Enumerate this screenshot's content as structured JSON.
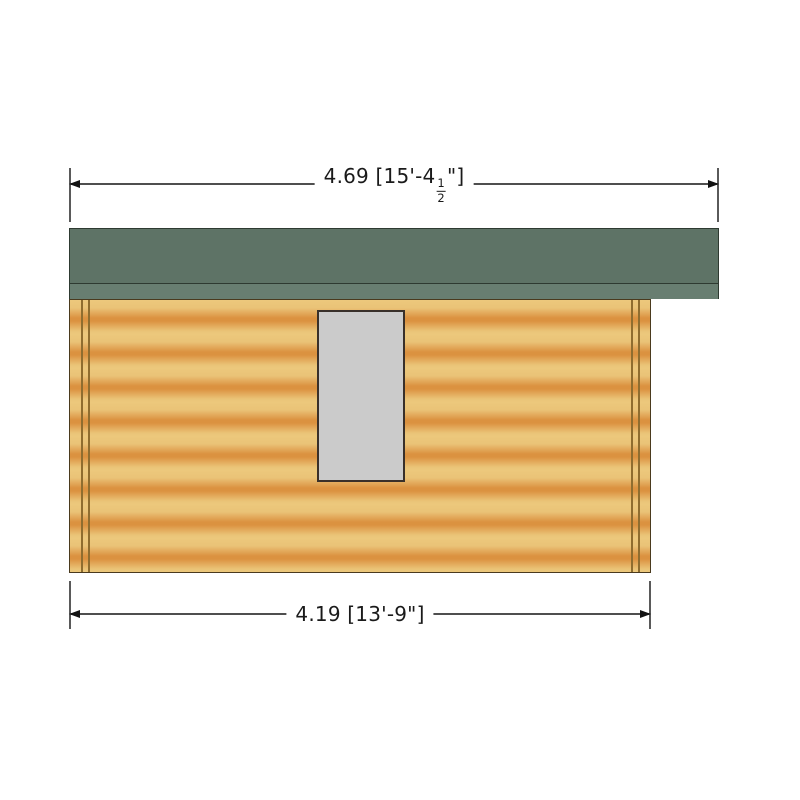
{
  "dimensions": {
    "top": {
      "metric": "4.69",
      "imperial": "15'-4 1/2\"",
      "label_prefix": "4.69 [15'-4",
      "fraction_numerator": "1",
      "fraction_denominator": "2",
      "label_suffix": "\"]"
    },
    "bottom": {
      "metric": "4.19",
      "imperial": "13'-9\"",
      "label": "4.19 [13'-9\"]"
    }
  },
  "colors": {
    "background": "#ffffff",
    "roof": "#5e7366",
    "roof_fascia": "#687e71",
    "roof_outline": "#2e3a31",
    "wall_light": "#eac377",
    "wall_orange": "#db9240",
    "wall_outline": "#4a3a1e",
    "corner_trim": "#8f6d2f",
    "window_fill": "#cbcbcb",
    "window_border": "#39302a",
    "dimension_line": "#4f4f4f",
    "text": "#1a1a1a"
  }
}
